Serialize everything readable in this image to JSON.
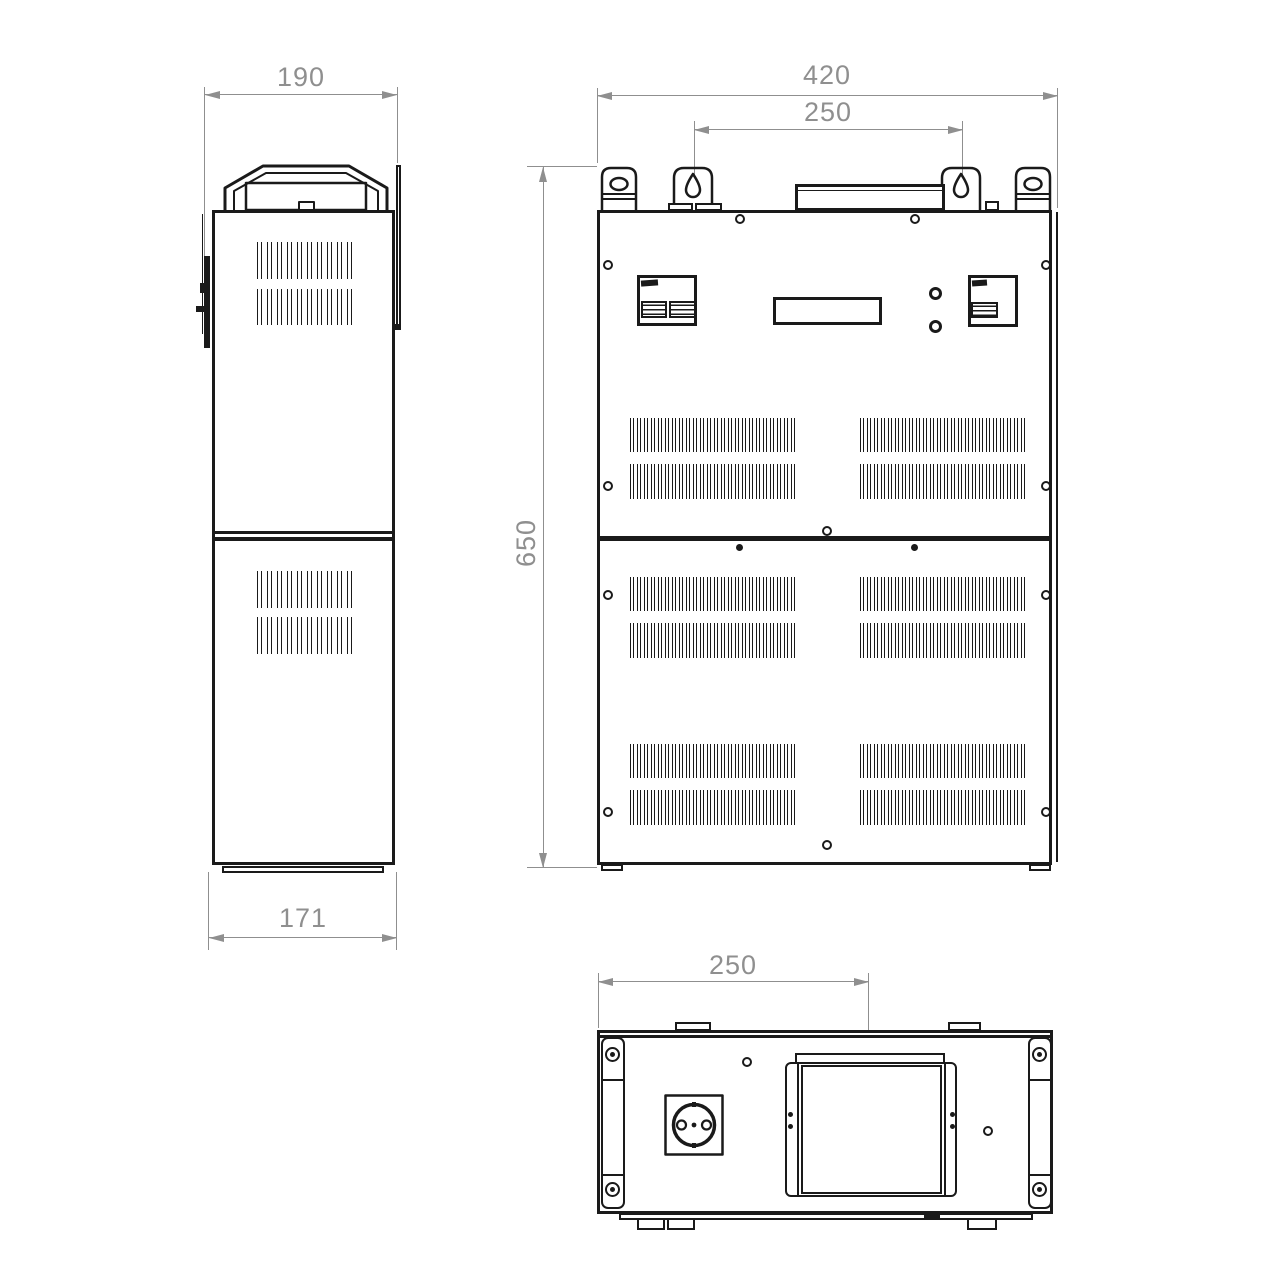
{
  "dims": {
    "side_width": "190",
    "side_depth": "171",
    "front_width": "420",
    "front_mount_spacing": "250",
    "front_height": "650",
    "bottom_plate_offset": "250"
  },
  "colors": {
    "line": "#1a1a1a",
    "dimension": "#8f8f8f",
    "background": "#ffffff"
  }
}
